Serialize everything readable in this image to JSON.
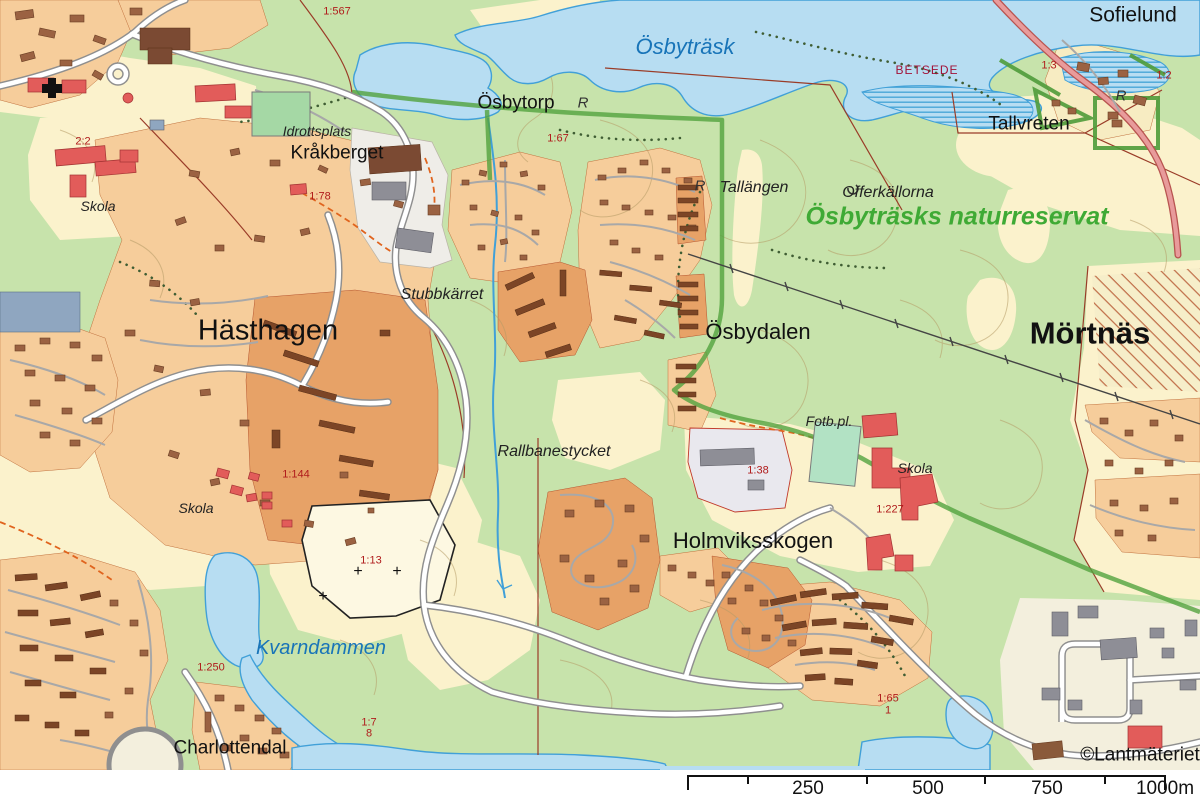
{
  "map": {
    "attribution": "©Lantmäteriet",
    "colors": {
      "forest": "#c7e3ab",
      "open_land": "#fbf2cc",
      "water": "#b7ddf2",
      "water_outline": "#41a0d8",
      "water_label": "#1874b8",
      "residential_light": "#f6cd9b",
      "residential_dark": "#e7a267",
      "building_brown": "#9b6242",
      "building_public_red": "#e25c5a",
      "building_gray": "#8e8e96",
      "road_fill": "#ffffff",
      "road_casing": "#8f8f8f",
      "main_road_pink": "#e89b9b",
      "reserve_boundary": "#53a33e",
      "reserve_label": "#3faa35",
      "parcel_label": "#b01c1c",
      "contour": "#b59b66",
      "boundary_red": "#9a3c28"
    },
    "labels": [
      {
        "id": "p1-567",
        "text": "1:567",
        "cls": "parcel",
        "x": 337,
        "y": 12
      },
      {
        "id": "osbytrask",
        "text": "Ösbyträsk",
        "cls": "water-lg",
        "x": 685,
        "y": 47
      },
      {
        "id": "osbytorp",
        "text": "Ösbytorp",
        "cls": "place-sm",
        "x": 516,
        "y": 103
      },
      {
        "id": "sofielund",
        "text": "Sofielund",
        "cls": "place-md",
        "x": 1133,
        "y": 15
      },
      {
        "id": "betsede",
        "text": "BETSEDE",
        "cls": "betsede",
        "x": 927,
        "y": 70
      },
      {
        "id": "tallvreten",
        "text": "Tallvreten",
        "cls": "place-sm",
        "x": 1029,
        "y": 124
      },
      {
        "id": "p1-3",
        "text": "1:3",
        "cls": "parcel",
        "x": 1049,
        "y": 66
      },
      {
        "id": "p1-2",
        "text": "1:2",
        "cls": "parcel",
        "x": 1164,
        "y": 76
      },
      {
        "id": "tallangen",
        "text": "Tallängen",
        "cls": "nature-it",
        "x": 754,
        "y": 188
      },
      {
        "id": "offerkallorna",
        "text": "Offerkällorna",
        "cls": "nature-it",
        "x": 888,
        "y": 193
      },
      {
        "id": "naturreservat",
        "text": "Ösbyträsks naturreservat",
        "cls": "reserve",
        "x": 957,
        "y": 217
      },
      {
        "id": "idrottsplats",
        "text": "Idrottsplats",
        "cls": "nature-it-sm",
        "x": 317,
        "y": 131
      },
      {
        "id": "krakberget",
        "text": "Kråkberget",
        "cls": "place-sm",
        "x": 337,
        "y": 153
      },
      {
        "id": "p1-78",
        "text": "1:78",
        "cls": "parcel",
        "x": 320,
        "y": 197
      },
      {
        "id": "p1-67",
        "text": "1:67",
        "cls": "parcel",
        "x": 558,
        "y": 139
      },
      {
        "id": "p2-2",
        "text": "2:2",
        "cls": "parcel",
        "x": 83,
        "y": 142
      },
      {
        "id": "skola-w",
        "text": "Skola",
        "cls": "nature-it-sm",
        "x": 98,
        "y": 206
      },
      {
        "id": "hasthagen",
        "text": "Hästhagen",
        "cls": "place-xl",
        "x": 268,
        "y": 331
      },
      {
        "id": "stubbkarret",
        "text": "Stubbkärret",
        "cls": "nature-it",
        "x": 442,
        "y": 295
      },
      {
        "id": "osbydalen",
        "text": "Ösbydalen",
        "cls": "place-lg2",
        "x": 758,
        "y": 332
      },
      {
        "id": "mortnas",
        "text": "Mörtnäs",
        "cls": "place-xxl",
        "x": 1090,
        "y": 333
      },
      {
        "id": "rallbanestycket",
        "text": "Rallbanestycket",
        "cls": "nature-it",
        "x": 554,
        "y": 452
      },
      {
        "id": "fotbpl",
        "text": "Fotb.pl.",
        "cls": "nature-it-sm",
        "x": 829,
        "y": 421
      },
      {
        "id": "skola-e",
        "text": "Skola",
        "cls": "nature-it-sm",
        "x": 915,
        "y": 468
      },
      {
        "id": "p1-227",
        "text": "1:227",
        "cls": "parcel",
        "x": 890,
        "y": 510
      },
      {
        "id": "p1-38",
        "text": "1:38",
        "cls": "parcel",
        "x": 758,
        "y": 471
      },
      {
        "id": "holmviksskogen",
        "text": "Holmviksskogen",
        "cls": "place-lg2",
        "x": 753,
        "y": 541
      },
      {
        "id": "skola-s",
        "text": "Skola",
        "cls": "nature-it-sm",
        "x": 196,
        "y": 508
      },
      {
        "id": "p1-144",
        "text": "1:144",
        "cls": "parcel",
        "x": 296,
        "y": 475
      },
      {
        "id": "p1-13",
        "text": "1:13",
        "cls": "parcel",
        "x": 371,
        "y": 561
      },
      {
        "id": "p1-250",
        "text": "1:250",
        "cls": "parcel",
        "x": 211,
        "y": 668
      },
      {
        "id": "charlottendal",
        "text": "Charlottendal",
        "cls": "place-sm",
        "x": 230,
        "y": 748
      },
      {
        "id": "kvarndammen",
        "text": "Kvarndammen",
        "cls": "water-md",
        "x": 321,
        "y": 648
      },
      {
        "id": "p1-7",
        "text": "1:7",
        "cls": "parcel",
        "x": 369,
        "y": 723
      },
      {
        "id": "p8",
        "text": "8",
        "cls": "parcel",
        "x": 369,
        "y": 734
      },
      {
        "id": "p1-65",
        "text": "1:65",
        "cls": "parcel",
        "x": 888,
        "y": 699
      },
      {
        "id": "p1",
        "text": "1",
        "cls": "parcel",
        "x": 888,
        "y": 711
      },
      {
        "id": "attribution",
        "text": "©Lantmäteriet",
        "cls": "attribution",
        "x": 1140,
        "y": 755
      },
      {
        "id": "rune-1",
        "text": "R",
        "cls": "rune",
        "x": 583,
        "y": 103
      },
      {
        "id": "rune-2",
        "text": "R",
        "cls": "rune",
        "x": 700,
        "y": 186
      },
      {
        "id": "rune-3",
        "text": "R",
        "cls": "rune",
        "x": 1121,
        "y": 96
      },
      {
        "id": "cross-1",
        "text": "+",
        "cls": "cross",
        "x": 323,
        "y": 597
      },
      {
        "id": "cross-2",
        "text": "+",
        "cls": "cross",
        "x": 358,
        "y": 572
      },
      {
        "id": "cross-3",
        "text": "+",
        "cls": "cross",
        "x": 397,
        "y": 572
      }
    ]
  },
  "scalebar": {
    "labels": [
      {
        "text": "250",
        "x": 808
      },
      {
        "text": "500",
        "x": 928
      },
      {
        "text": "750",
        "x": 1047
      },
      {
        "text": "1000m",
        "x": 1165
      }
    ]
  }
}
